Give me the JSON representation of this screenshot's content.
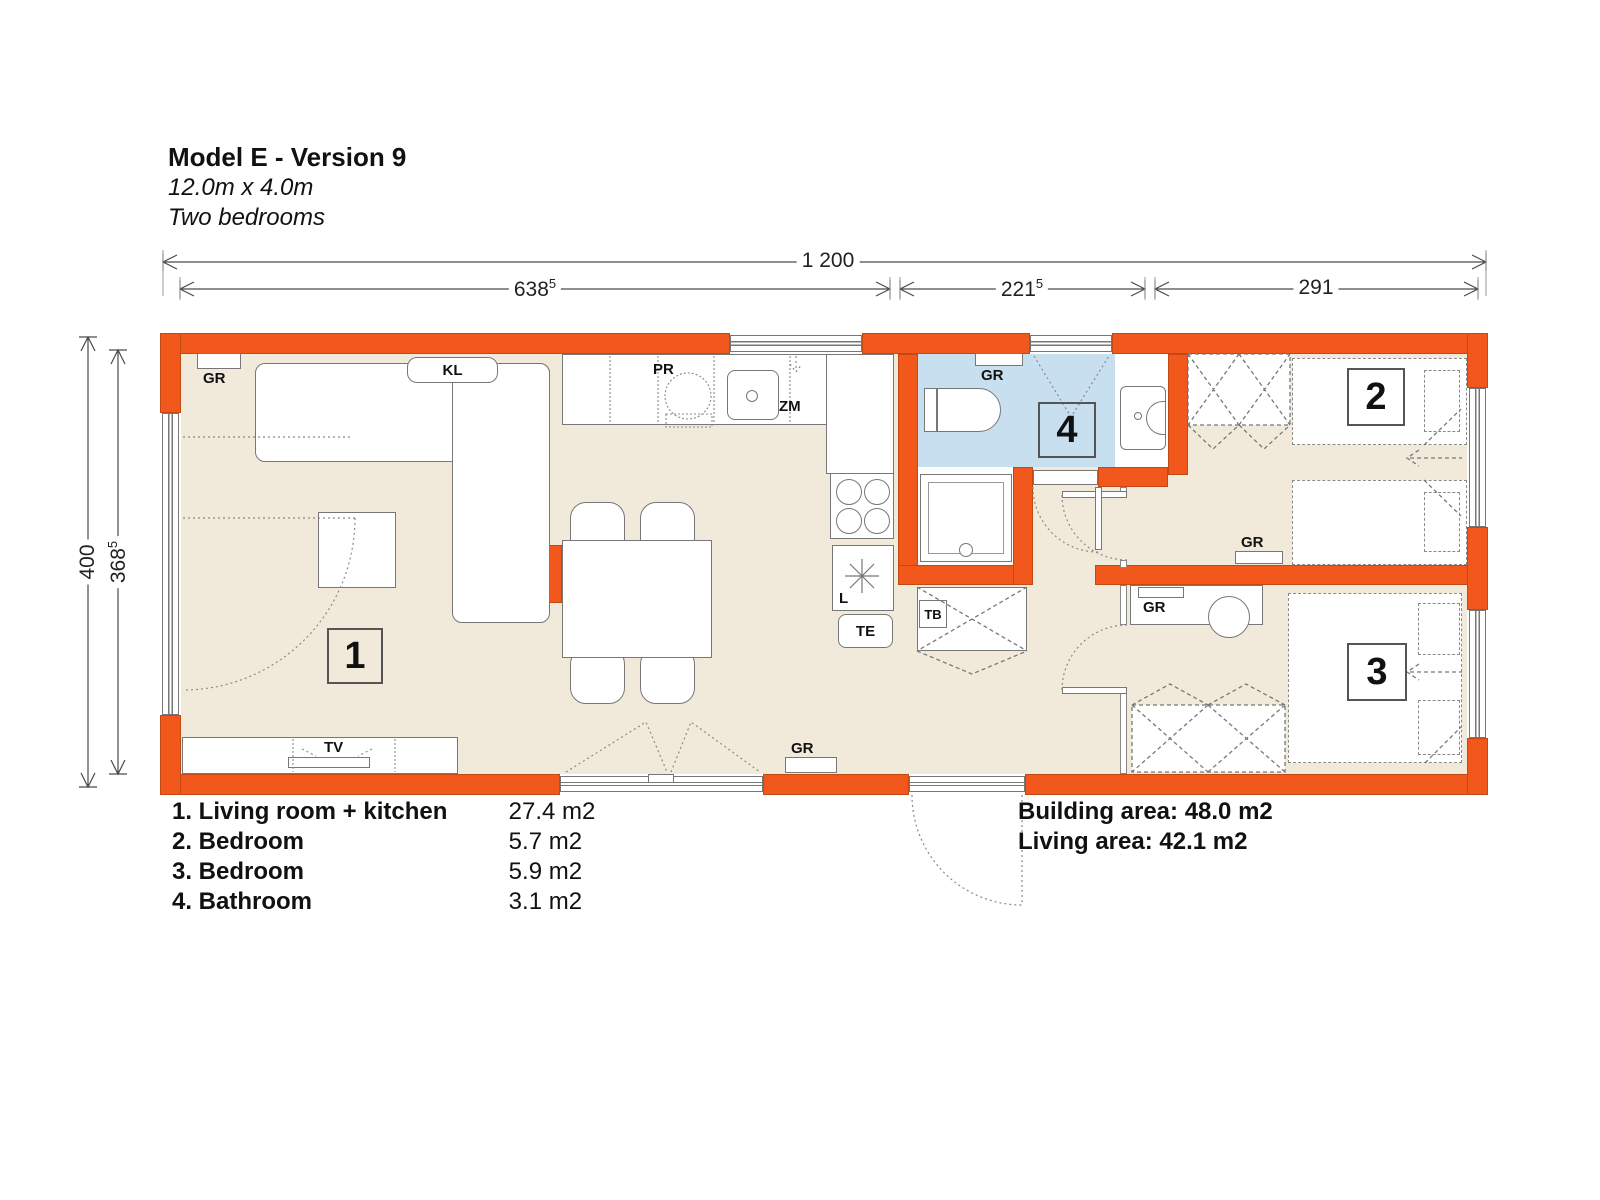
{
  "title": {
    "name": "Model E - Version 9",
    "size": "12.0m x 4.0m",
    "type": "Two bedrooms"
  },
  "dimensions": {
    "total_width": "1 200",
    "seg1": {
      "main": "638",
      "sup": "5"
    },
    "seg2": {
      "main": "221",
      "sup": "5"
    },
    "seg3": "291",
    "total_height": "400",
    "inner_height": {
      "main": "368",
      "sup": "5"
    }
  },
  "labels": {
    "gr": "GR",
    "kl": "KL",
    "pr": "PR",
    "zm": "ZM",
    "tv": "TV",
    "fridge": "L",
    "te": "TE",
    "tb": "TB"
  },
  "rooms": {
    "living": "1",
    "bedroom2": "2",
    "bedroom3": "3",
    "bathroom": "4"
  },
  "legend": [
    {
      "label": "1. Living room + kitchen",
      "area": "27.4 m2"
    },
    {
      "label": "2. Bedroom",
      "area": "5.7 m2"
    },
    {
      "label": "3. Bedroom",
      "area": "5.9 m2"
    },
    {
      "label": "4. Bathroom",
      "area": "3.1 m2"
    }
  ],
  "summary": {
    "building": "Building area: 48.0 m2",
    "living": "Living area: 42.1 m2"
  },
  "colors": {
    "wall": "#F2571C",
    "floor": "#F1EADB",
    "bathroom": "#C8DFF0"
  }
}
